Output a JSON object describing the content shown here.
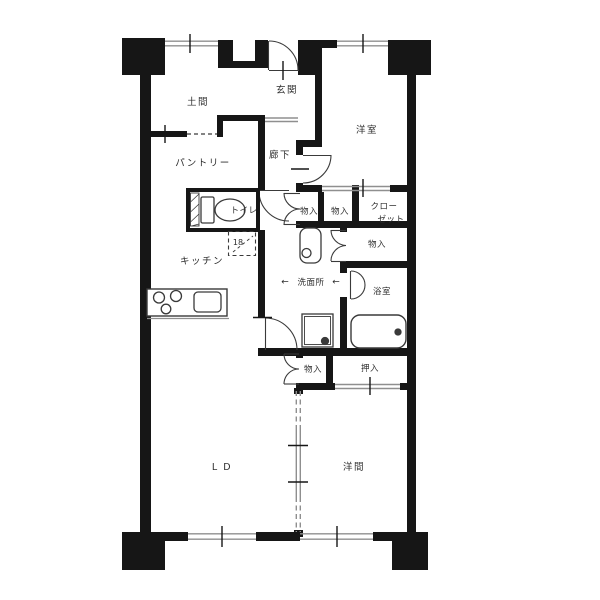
{
  "floor_plan": {
    "colors": {
      "wall": "#161616",
      "opening_line": "#8f8f8f",
      "fixture_line": "#3a3a3a",
      "label_text": "#2e2e2e",
      "background": "#ffffff"
    },
    "rooms": {
      "doma": "土間",
      "genkan": "玄関",
      "corridor": "廊下",
      "pantry": "パントリー",
      "bedroom_upper": "洋室",
      "toilet": "トイレ",
      "kitchen": "キッチン",
      "washroom": "洗面所",
      "bathroom": "浴室",
      "living_dining": "L D",
      "bedroom_lower": "洋間"
    },
    "storage": {
      "hall_storage_1": "物入",
      "hall_storage_2": "物入",
      "closet_line_1": "クロー",
      "closet_line_2": "ゼット",
      "washroom_storage": "物入",
      "ld_storage": "物入",
      "oshiire": "押入"
    },
    "annotations": {
      "refrigerator_size": "18",
      "washroom_arrow_left": "←",
      "washroom_arrow_right": "←"
    }
  }
}
